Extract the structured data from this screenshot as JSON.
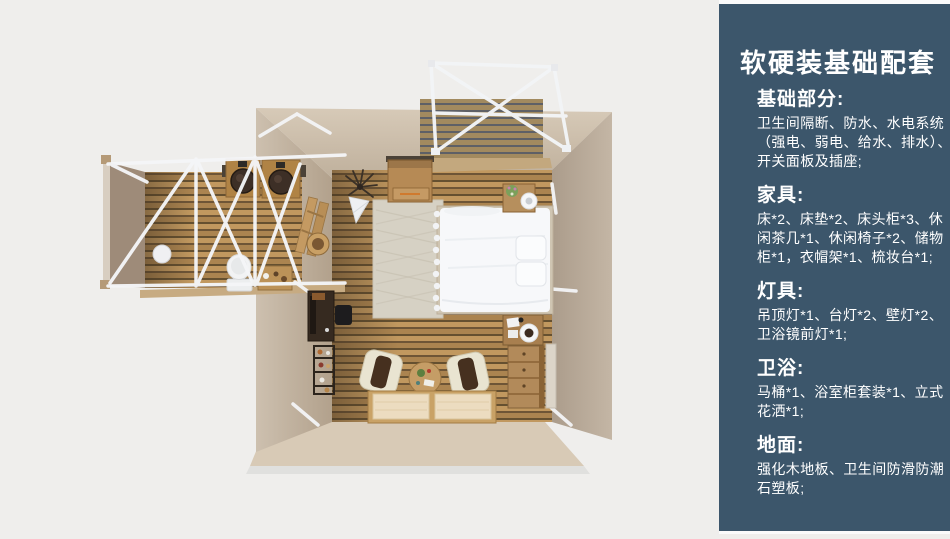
{
  "palette": {
    "page_bg": "#efeeec",
    "sidebar_bg": "#3c566b",
    "sidebar_text": "#ffffff",
    "wall_beige": "#cfc1ae",
    "floor_wood": "#b8915a",
    "frame_white": "#f5f6f8",
    "bed_white": "#f7f8fa"
  },
  "sidebar": {
    "title": "软硬装基础配套",
    "sections": [
      {
        "heading": "基础部分:",
        "lines": [
          "卫生间隔断、防水、水电系统",
          "（强电、弱电、给水、排水）、",
          "开关面板及插座;"
        ]
      },
      {
        "heading": "家具:",
        "lines": [
          "床*2、床垫*2、床头柜*3、休",
          "闲茶几*1、休闲椅子*2、储物",
          "柜*1，衣帽架*1、梳妆台*1;"
        ]
      },
      {
        "heading": "灯具:",
        "lines": [
          "吊顶灯*1、台灯*2、壁灯*2、",
          "卫浴镜前灯*1;"
        ]
      },
      {
        "heading": "卫浴:",
        "lines": [
          "马桶*1、浴室柜套装*1、立式",
          "花洒*1;"
        ]
      },
      {
        "heading": "地面:",
        "lines": [
          "强化木地板、卫生间防滑防潮",
          "石塑板;"
        ]
      }
    ]
  },
  "floorplan": {
    "elements": [
      "bedroom",
      "bathroom-wing",
      "balcony-deck",
      "canopy-frame",
      "bed",
      "rug",
      "nightstand",
      "storage-cabinet",
      "ceiling-lamp",
      "desk",
      "shelf-rack",
      "lounge-chair",
      "coffee-table",
      "floor-mats",
      "dresser",
      "vanity",
      "mirror-panel",
      "double-sink-vanity",
      "toilet",
      "toiletry-table",
      "ball-stool",
      "ladder-rack",
      "basket"
    ]
  }
}
